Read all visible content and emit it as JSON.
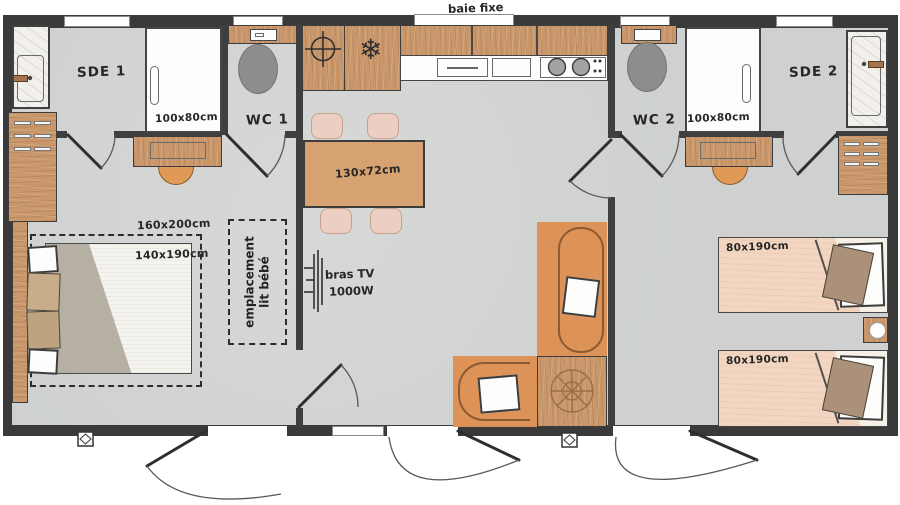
{
  "plan": {
    "type": "floorplan",
    "top_window_label": "baie fixe",
    "bathroom1": {
      "name": "SDE 1",
      "shower_tray_dim": "100x80cm"
    },
    "toilet1": {
      "name": "WC 1"
    },
    "bathroom2": {
      "name": "SDE 2",
      "shower_tray_dim": "100x80cm"
    },
    "toilet2": {
      "name": "WC 2"
    },
    "dining": {
      "table_dim": "130x72cm"
    },
    "living": {
      "tv_label": "bras TV",
      "tv_power": "1000W"
    },
    "bedroom_master": {
      "zone_dim": "160x200cm",
      "bed_dim": "140x190cm",
      "baby_area_line1": "emplacement",
      "baby_area_line2": "lit bébé"
    },
    "bedroom_twin": {
      "bed1_dim": "80x190cm",
      "bed2_dim": "80x190cm"
    },
    "icons": {
      "freezer": "❄"
    },
    "colors": {
      "wall": "#3a3a3a",
      "floor": "#ced1cf",
      "wood": "#c9976a",
      "sofa_orange": "#dd9357",
      "chair_pink": "#eccfc2",
      "twin_mattress": "#f2d6c2",
      "toilet_grey": "#8d8d8d",
      "text": "#262626"
    }
  }
}
